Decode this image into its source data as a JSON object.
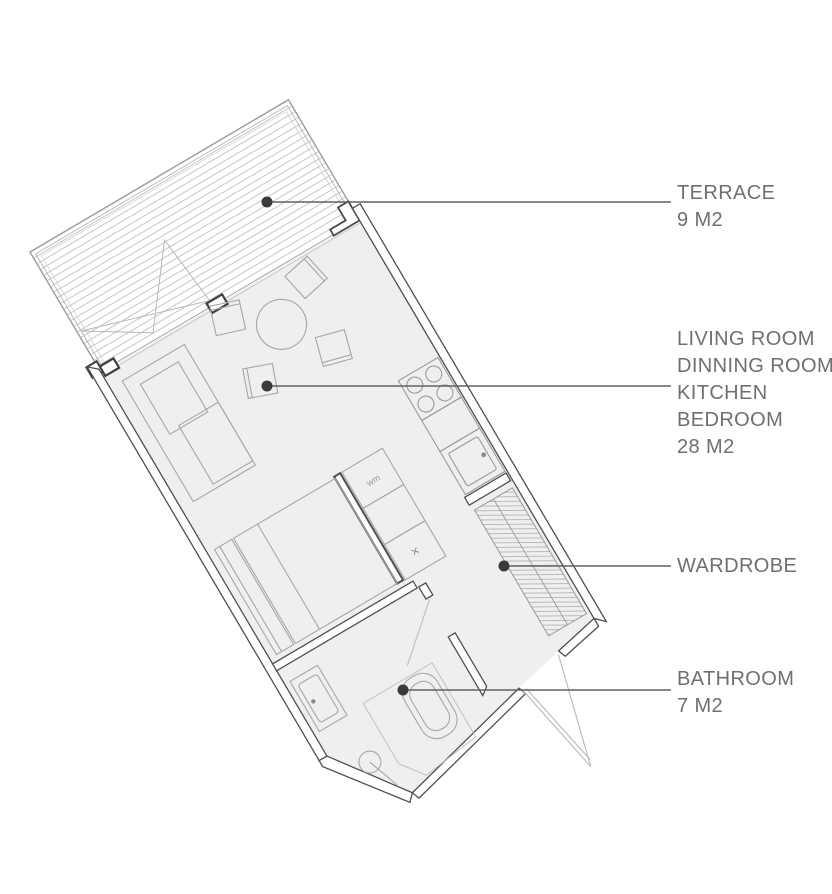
{
  "annotations": {
    "terrace": {
      "lines": [
        "TERRACE",
        "9 M2"
      ]
    },
    "living": {
      "lines": [
        "LIVING ROOM",
        "DINNING ROOM",
        "KITCHEN",
        "BEDROOM",
        "28 M2"
      ]
    },
    "wardrobe": {
      "lines": [
        "WARDROBE"
      ]
    },
    "bathroom": {
      "lines": [
        "BATHROOM",
        "7 M2"
      ]
    }
  },
  "plan": {
    "cabinet_labels": {
      "washing_machine": "wm",
      "cross": "×"
    }
  },
  "colors": {
    "wall_line": "#4f4f4f",
    "floor_fill": "#efefef",
    "furniture_line": "#a6a6a6",
    "deck_line": "#c5c5c5",
    "hatch_line": "#b4b4b4",
    "leader_line": "#606060",
    "leader_dot": "#3a3a3a",
    "label_text": "#6f6f6f"
  }
}
